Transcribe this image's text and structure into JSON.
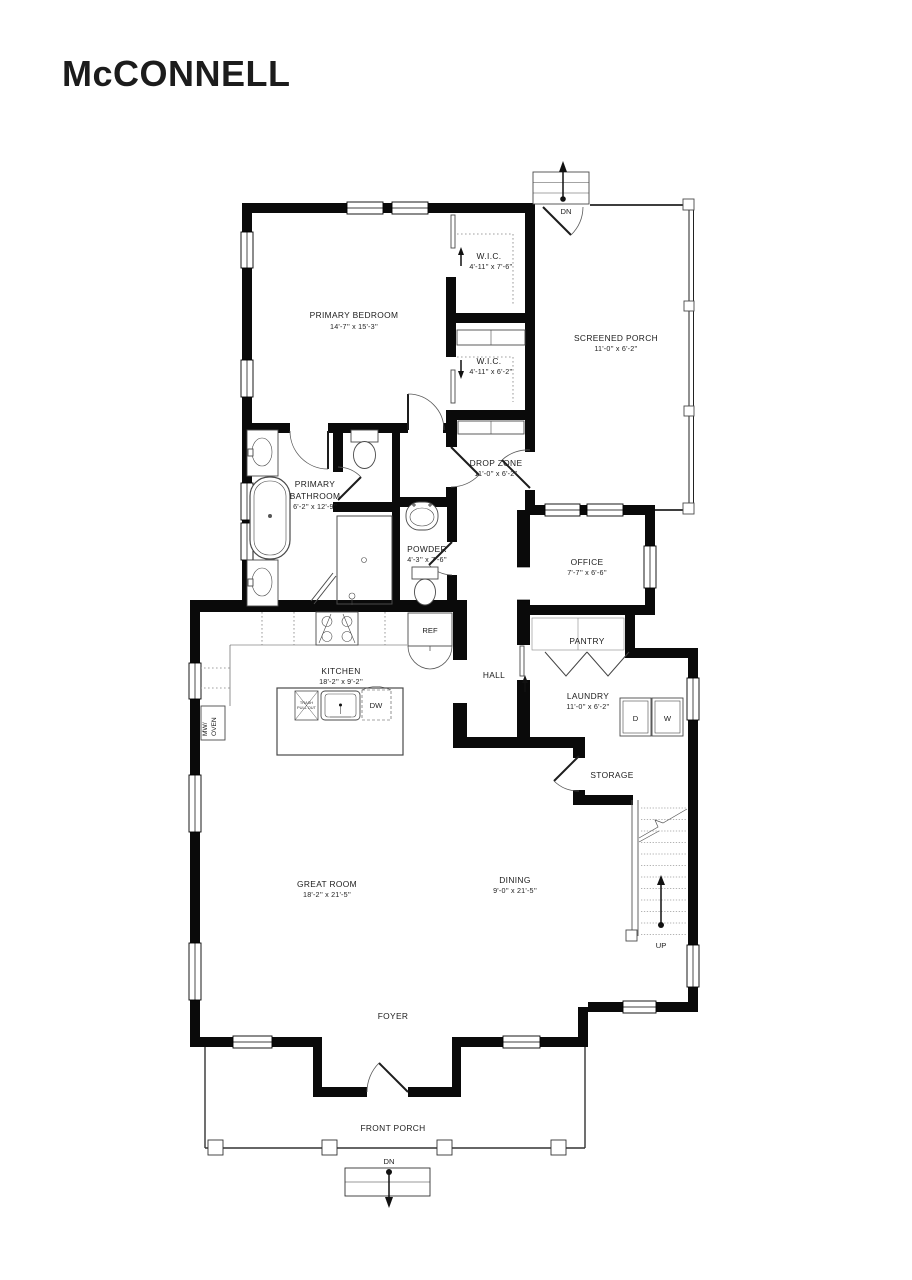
{
  "title": {
    "text": "McCONNELL"
  },
  "colors": {
    "title": "#173f6f",
    "wall": "#0a0a0a",
    "line": "#4a4a4a"
  },
  "rooms": [
    {
      "name": "PRIMARY BEDROOM",
      "dims": "14'-7'' x 15'-3''"
    },
    {
      "name": "W.I.C.",
      "dims": "4'-11'' x 7'-6''"
    },
    {
      "name": "W.I.C.",
      "dims": "4'-11'' x 6'-2''"
    },
    {
      "name": "SCREENED PORCH",
      "dims": "11'-0'' x 6'-2''"
    },
    {
      "name_line1": "PRIMARY",
      "name_line2": "BATHROOM",
      "dims": "6'-2'' x 12'-9''"
    },
    {
      "name": "DROP ZONE",
      "dims": "11'-0'' x 6'-2''"
    },
    {
      "name": "POWDER",
      "dims": "4'-3'' x 7'-6''"
    },
    {
      "name": "OFFICE",
      "dims": "7'-7'' x 6'-6''"
    },
    {
      "name": "KITCHEN",
      "dims": "18'-2'' x 9'-2''"
    },
    {
      "name": "HALL"
    },
    {
      "name": "PANTRY"
    },
    {
      "name": "LAUNDRY",
      "dims": "11'-0'' x 6'-2''"
    },
    {
      "name": "STORAGE"
    },
    {
      "name": "GREAT ROOM",
      "dims": "18'-2'' x 21'-5''"
    },
    {
      "name": "DINING",
      "dims": "9'-0'' x 21'-5''"
    },
    {
      "name": "FOYER"
    },
    {
      "name": "FRONT PORCH"
    }
  ],
  "appliances": {
    "ref": "REF",
    "dw": "DW",
    "dryer": "D",
    "washer": "W",
    "mw_line1": "MW/",
    "mw_line2": "OVEN",
    "trash_line1": "TRASH",
    "trash_line2": "PULL OUT"
  },
  "stairs_labels": {
    "up": "UP",
    "dn_porch": "DN",
    "dn_entry": "DN"
  }
}
